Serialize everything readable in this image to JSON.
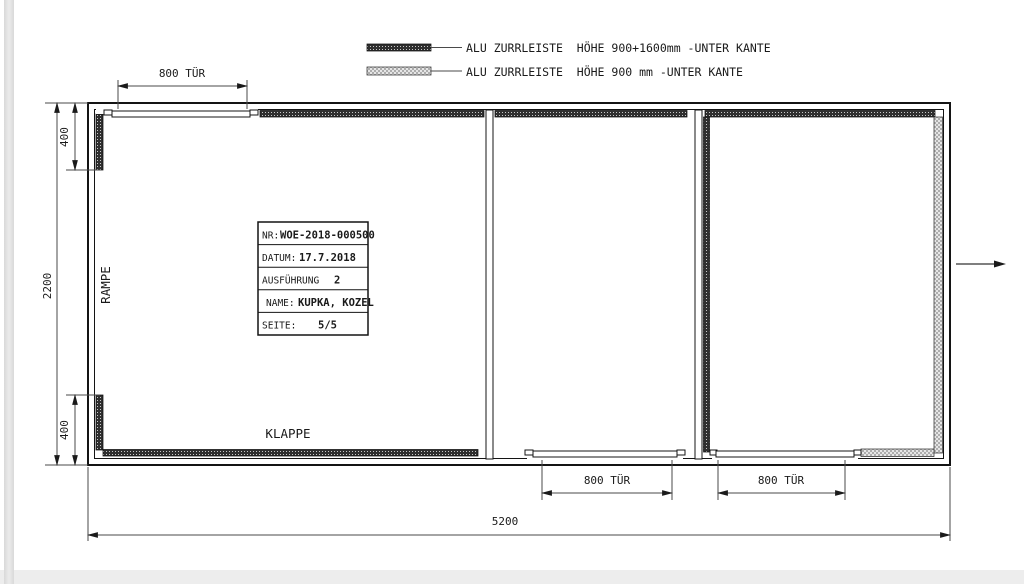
{
  "legend": {
    "items": [
      {
        "swatch": "dark-hatch",
        "label": "ALU ZURRLEISTE  HÖHE 900+1600mm -UNTER KANTE"
      },
      {
        "swatch": "light-hatch",
        "label": "ALU ZURRLEISTE  HÖHE 900 mm -UNTER KANTE"
      }
    ]
  },
  "title_block": {
    "rows": [
      {
        "label": "NR:",
        "value": "WOE-2018-000500"
      },
      {
        "label": "DATUM:",
        "value": "17.7.2018"
      },
      {
        "label": "AUSFÜHRUNG",
        "value": "2"
      },
      {
        "label": "NAME:",
        "value": "KUPKA, KOZEL"
      },
      {
        "label": "SEITE:",
        "value": "5/5"
      }
    ]
  },
  "dimensions": {
    "door_top": "800 TÜR",
    "door_mid": "800 TÜR",
    "door_right": "800 TÜR",
    "height_total": "2200",
    "height_top": "400",
    "height_bottom": "400",
    "width_total": "5200"
  },
  "labels": {
    "ramp": "RAMPE",
    "flap": "KLAPPE"
  },
  "colors": {
    "line": "#1a1a1a",
    "dim_line": "#4a4a4a",
    "hatch_dark": "#2f2f2f",
    "hatch_light": "#b8b8b8"
  }
}
